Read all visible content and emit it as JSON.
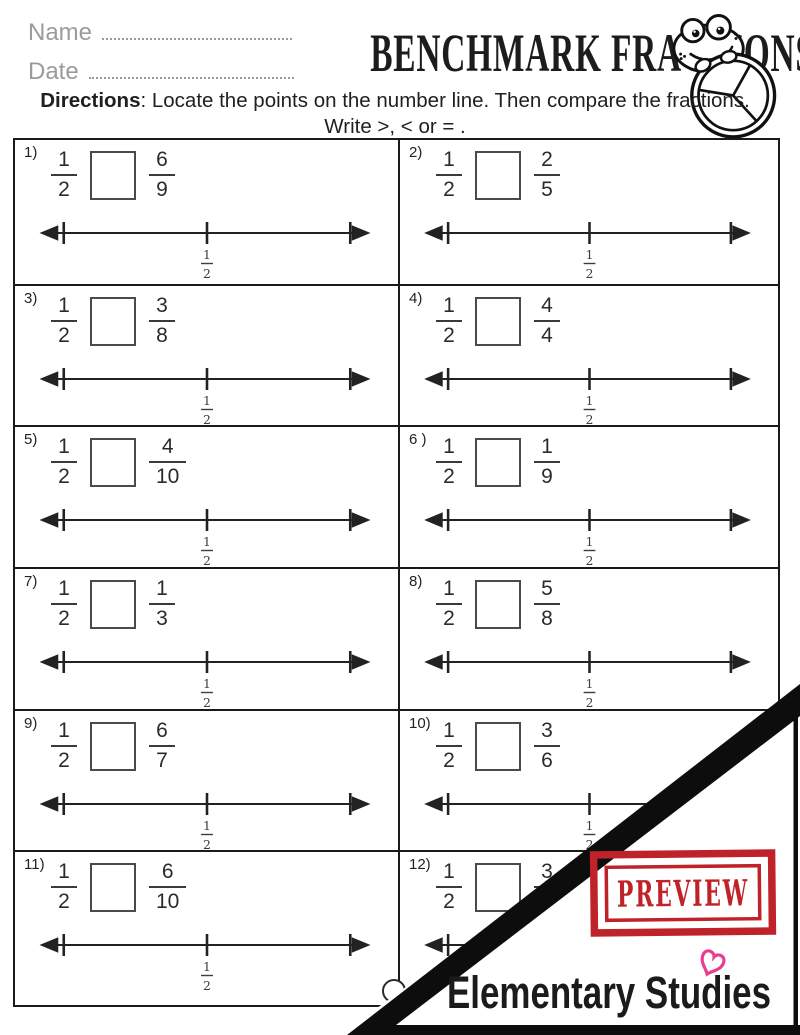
{
  "header": {
    "name_label": "Name",
    "date_label": "Date",
    "title": "BENCHMARK FRACTIONS",
    "directions_bold": "Directions",
    "directions_rest": ": Locate the points on the number line. Then compare the fractions.",
    "directions_line2": "Write >, < or = ."
  },
  "mascot": "frog-holding-thirds-fraction-circle",
  "number_line": {
    "label_num": "1",
    "label_den": "2"
  },
  "problems": [
    {
      "label": "1)",
      "f1": {
        "num": "1",
        "den": "2"
      },
      "f2": {
        "num": "6",
        "den": "9"
      }
    },
    {
      "label": "2)",
      "f1": {
        "num": "1",
        "den": "2"
      },
      "f2": {
        "num": "2",
        "den": "5"
      }
    },
    {
      "label": "3)",
      "f1": {
        "num": "1",
        "den": "2"
      },
      "f2": {
        "num": "3",
        "den": "8"
      }
    },
    {
      "label": "4)",
      "f1": {
        "num": "1",
        "den": "2"
      },
      "f2": {
        "num": "4",
        "den": "4"
      }
    },
    {
      "label": "5)",
      "f1": {
        "num": "1",
        "den": "2"
      },
      "f2": {
        "num": "4",
        "den": "10"
      }
    },
    {
      "label": "6 )",
      "f1": {
        "num": "1",
        "den": "2"
      },
      "f2": {
        "num": "1",
        "den": "9"
      }
    },
    {
      "label": "7)",
      "f1": {
        "num": "1",
        "den": "2"
      },
      "f2": {
        "num": "1",
        "den": "3"
      }
    },
    {
      "label": "8)",
      "f1": {
        "num": "1",
        "den": "2"
      },
      "f2": {
        "num": "5",
        "den": "8"
      }
    },
    {
      "label": "9)",
      "f1": {
        "num": "1",
        "den": "2"
      },
      "f2": {
        "num": "6",
        "den": "7"
      }
    },
    {
      "label": "10)",
      "f1": {
        "num": "1",
        "den": "2"
      },
      "f2": {
        "num": "3",
        "den": "6"
      }
    },
    {
      "label": "11)",
      "f1": {
        "num": "1",
        "den": "2"
      },
      "f2": {
        "num": "6",
        "den": "10"
      }
    },
    {
      "label": "12)",
      "f1": {
        "num": "1",
        "den": "2"
      },
      "f2": {
        "num": "3",
        "den": ""
      }
    }
  ],
  "preview": {
    "stamp_text": "PREVIEW",
    "brand": "Elementary Studies",
    "stamp_color": "#bf2229",
    "heart_color": "#ea3d8e",
    "band_color": "#0d0d0d"
  }
}
